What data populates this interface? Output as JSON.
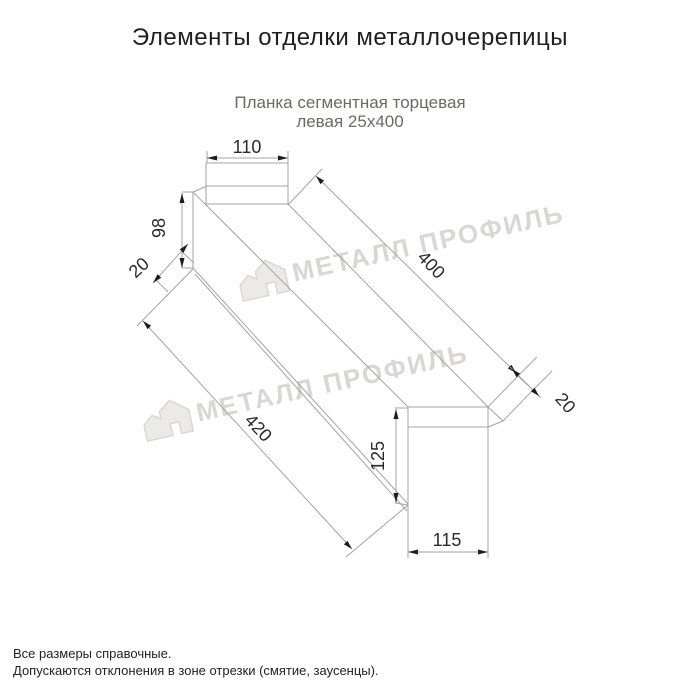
{
  "header": {
    "title": "Элементы отделки металлочерепицы",
    "subtitle_line1": "Планка сегментная торцевая",
    "subtitle_line2": "левая 25х400"
  },
  "drawing": {
    "dimensions": {
      "top_flange_width": "110",
      "face_height": "98",
      "left_hem": "20",
      "length_top": "400",
      "length_bottom": "420",
      "right_hem": "20",
      "end_height": "125",
      "end_width": "115"
    },
    "line_color": "#a3a3a3",
    "text_color": "#2a2a2a"
  },
  "watermark": {
    "text": "МЕТАЛЛ ПРОФИЛЬ",
    "color": "#d9d7d3"
  },
  "footer": {
    "line1": "Все размеры справочные.",
    "line2": "Допускаются отклонения в зоне отрезки (смятие, заусенцы)."
  }
}
